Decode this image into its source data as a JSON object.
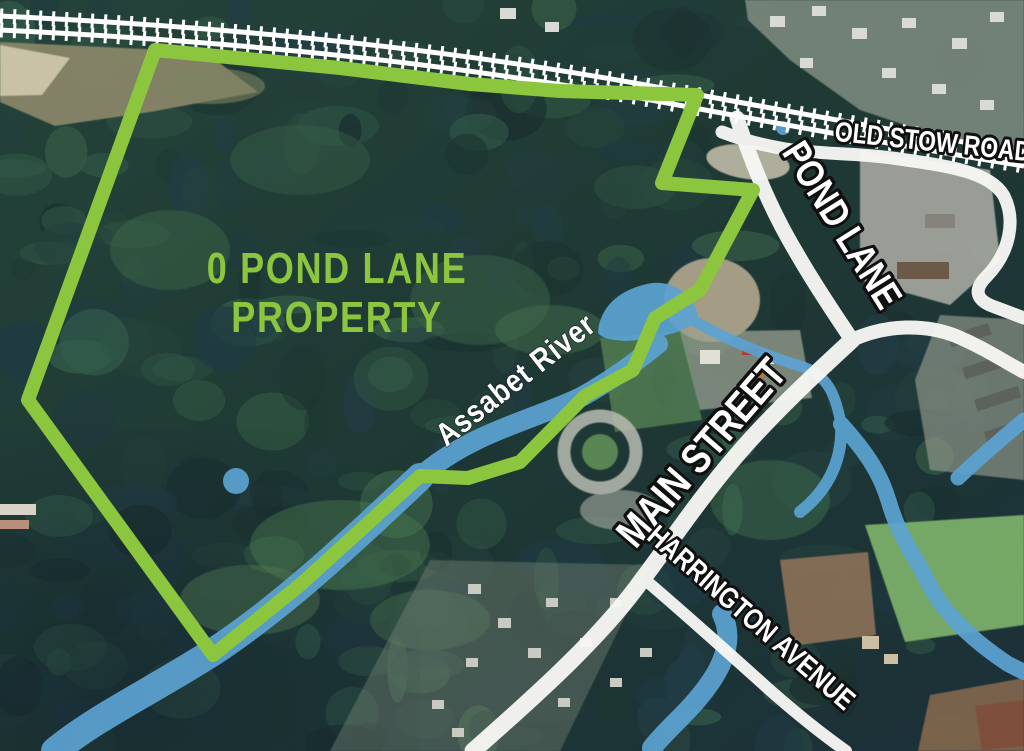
{
  "map": {
    "kind": "annotated aerial property map",
    "property_label": {
      "line1": "0 POND LANE",
      "line2": "PROPERTY"
    },
    "river_label": "Assabet River",
    "road_labels": {
      "old_stow_road": "OLD STOW ROAD",
      "pond_lane": "POND LANE",
      "main_street": "MAIN STREET",
      "harrington_avenue": "HARRINGTON AVENUE"
    },
    "colors": {
      "property_boundary": "#8CC63E",
      "property_label_text": "#8CC63E",
      "water": "#5CA3D3",
      "road": "#F7F7F4",
      "railroad": "#FFFFFF",
      "label_text": "#FFFFFF",
      "label_outline": "#101010"
    }
  }
}
